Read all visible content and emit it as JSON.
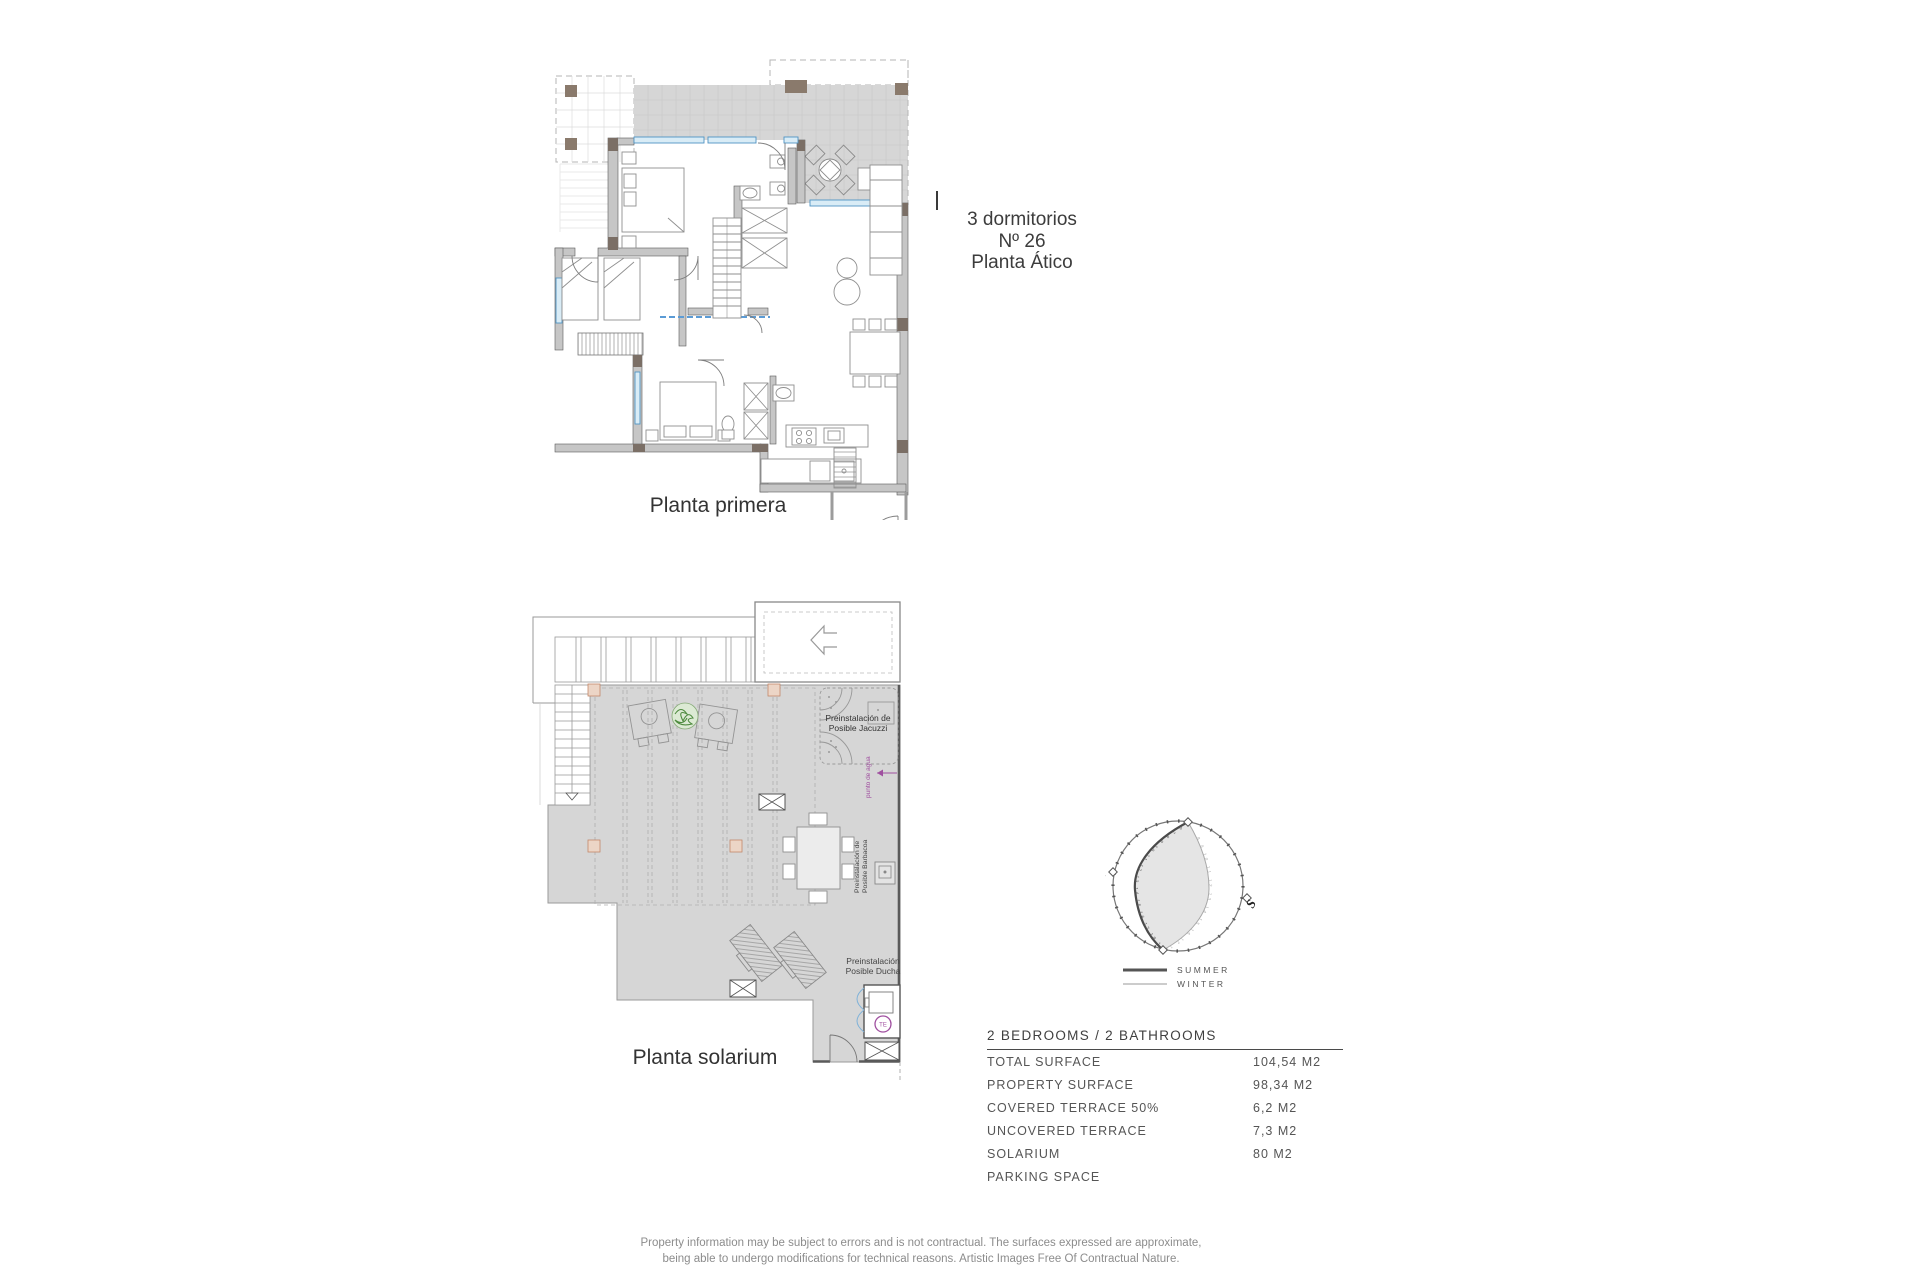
{
  "unit_info": {
    "bedrooms_line": "3 dormitorios",
    "number_line": "Nº 26",
    "floor_line": "Planta Ático"
  },
  "plans": {
    "first": {
      "label": "Planta primera"
    },
    "solarium": {
      "label": "Planta solarium",
      "jacuzzi_line1": "Preinstalación de",
      "jacuzzi_line2": "Posible Jacuzzi",
      "water_point": "punto de agua",
      "barbecue_line1": "Preinstalación de",
      "barbecue_line2": "Posible Barbacoa",
      "shower_line1": "Preinstalación",
      "shower_line2": "Posible Ducha",
      "heater_badge": "TE"
    }
  },
  "sun_diagram": {
    "north": "N",
    "south": "S",
    "summer_hours": "6  7  8  9  10  11  12  13  14  15  16  17  18  19  20",
    "winter_hours": "8  9  10  11  12  13  14  15  16  17  18",
    "legend_summer": "SUMMER",
    "legend_winter": "WINTER"
  },
  "spec_table": {
    "header": "2 BEDROOMS / 2 BATHROOMS",
    "rows": [
      {
        "label": "TOTAL SURFACE",
        "value": "104,54 M2"
      },
      {
        "label": "PROPERTY SURFACE",
        "value": "98,34 M2"
      },
      {
        "label": "COVERED TERRACE 50%",
        "value": "6,2 M2"
      },
      {
        "label": "UNCOVERED TERRACE",
        "value": "7,3 M2"
      },
      {
        "label": "SOLARIUM",
        "value": "80 M2"
      },
      {
        "label": "PARKING SPACE",
        "value": ""
      }
    ]
  },
  "footer": {
    "line1": "Property information may be subject to errors and is not contractual. The surfaces expressed are approximate,",
    "line2": "being able to undergo modifications for technical reasons. Artistic Images Free Of Contractual Nature."
  },
  "colors": {
    "terrace_gray": "#d6d6d6",
    "wall_gray": "#c6c6c6",
    "pillar_brown": "#8a7a6c",
    "window_blue": "#4f94c4",
    "accent_purple": "#a050a0",
    "plant_green": "#4e8b3f"
  }
}
